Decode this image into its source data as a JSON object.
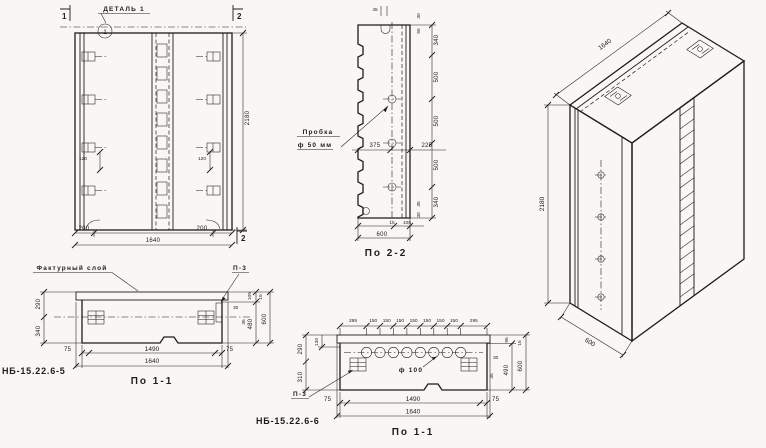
{
  "colors": {
    "ink": "#1e1d1a",
    "paper": "#f8f7f3"
  },
  "front_view": {
    "detail_label": "ДЕТАЛЬ 1",
    "detail_circle": "1",
    "cut_mark_1": "1",
    "cut_mark_2_top": "2",
    "cut_mark_2_bottom": "2",
    "dim_height": "2180",
    "dim_width": "1640",
    "dim_200_left": "200",
    "dim_200_right": "200",
    "dim_120_left": "120",
    "dim_120_right": "120"
  },
  "section_2_2": {
    "title": "По 2-2",
    "plug_label_1": "Пробка",
    "plug_label_2": "ф 50 мм",
    "dim_375": "375",
    "dim_225": "225",
    "dim_45": "45",
    "dim_30_top": "30",
    "dim_55": "55",
    "chain": [
      "340",
      "500",
      "500",
      "500",
      "340"
    ],
    "dim_35_bottom": "35",
    "dim_30_bottom": "30",
    "dim_15": "15",
    "dim_105": "105",
    "dim_600": "600"
  },
  "iso_view": {
    "dim_width": "1640",
    "dim_height": "2180",
    "dim_depth": "600"
  },
  "section_1_1_a": {
    "mark": "НБ-15.22.6-5",
    "title": "По 1-1",
    "facing_label": "Фактурный слой",
    "p3_label": "П-3",
    "dim_290": "290",
    "dim_340": "340",
    "dim_105": "105",
    "dim_15": "15",
    "dim_30": "30",
    "dim_35": "35",
    "dim_480": "480",
    "dim_600": "600",
    "dim_75_left": "75",
    "dim_1490": "1490",
    "dim_75_right": "75",
    "dim_1640": "1640"
  },
  "section_1_1_b": {
    "mark": "НБ-15.22.6-6",
    "title": "По 1-1",
    "p3_label": "П-3",
    "hole_label": "ф 100",
    "top_chain": [
      "295",
      "150",
      "150",
      "150",
      "150",
      "150",
      "150",
      "150",
      "295"
    ],
    "dim_290": "290",
    "dim_310": "310",
    "dim_130": "130",
    "dim_95": "95",
    "dim_15": "15",
    "dim_30": "30",
    "dim_35": "35",
    "dim_490": "490",
    "dim_600": "600",
    "dim_75_left": "75",
    "dim_1490": "1490",
    "dim_75_right": "75",
    "dim_1640": "1640"
  }
}
